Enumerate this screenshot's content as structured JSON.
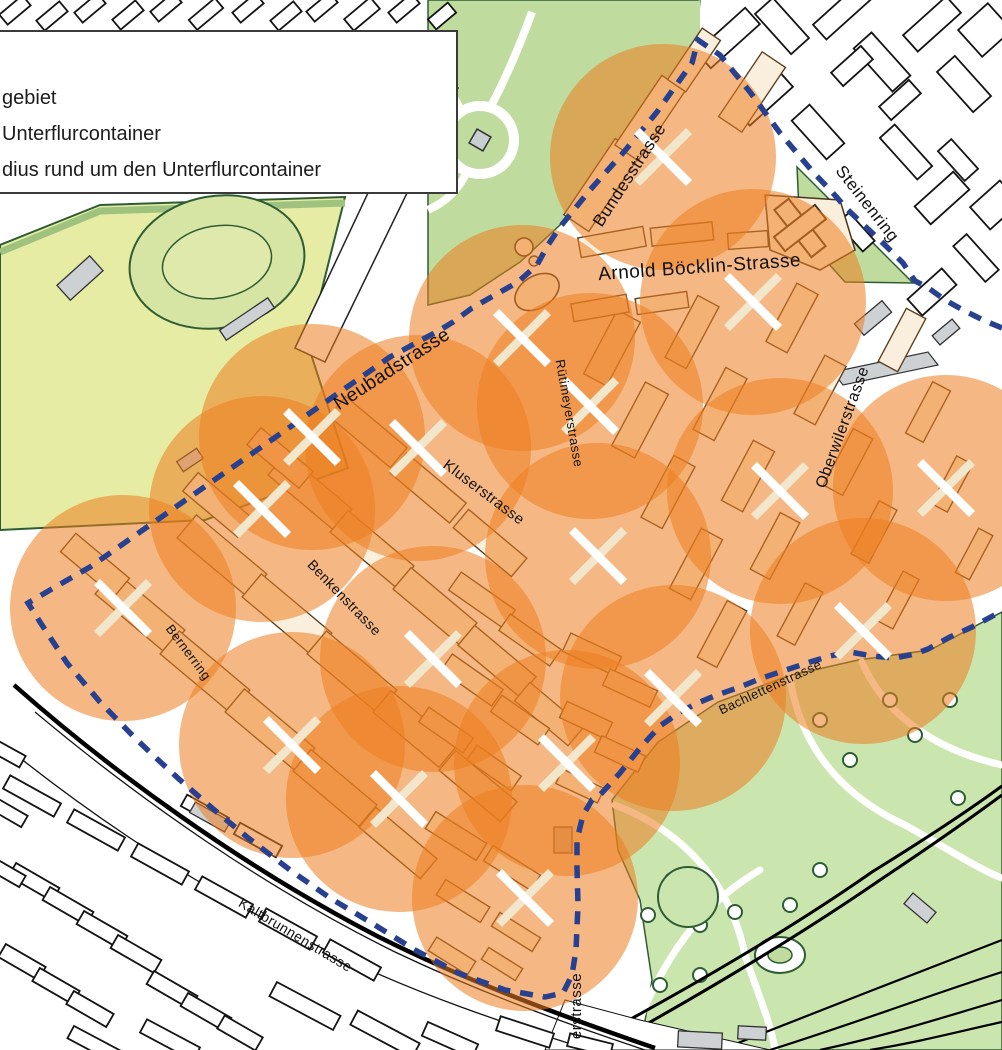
{
  "legend": {
    "items": [
      {
        "label": "gebiet"
      },
      {
        "label": "Unterflurcontainer"
      },
      {
        "label": "dius rund um den Unterflurcontainer"
      }
    ]
  },
  "map": {
    "colors": {
      "circle": "#ED7D1F",
      "circle_opacity": 0.55,
      "boundary": "#27408F",
      "marker_white": "#FFFFFF",
      "marker_cream": "#F2E7CC",
      "park_green": "#BFDB9E",
      "field_green": "#E6ECA4",
      "track_green": "#D6E4A4",
      "park_light": "#CBE5AF",
      "building_tint": "#FAEFDC",
      "building_outline_inner": "#5C4120",
      "building_outline_outer": "#141414",
      "gray_building": "#CDD1D3",
      "street_text": "#101010"
    },
    "containers": {
      "radius": 113,
      "points": [
        [
          663,
          157
        ],
        [
          753,
          302
        ],
        [
          522,
          338
        ],
        [
          590,
          406
        ],
        [
          312,
          437
        ],
        [
          418,
          448
        ],
        [
          780,
          491
        ],
        [
          946,
          488
        ],
        [
          262,
          509
        ],
        [
          123,
          608
        ],
        [
          598,
          556
        ],
        [
          863,
          631
        ],
        [
          433,
          659
        ],
        [
          673,
          698
        ],
        [
          292,
          745
        ],
        [
          567,
          763
        ],
        [
          399,
          799
        ],
        [
          525,
          898
        ]
      ]
    },
    "boundary": [
      [
        1002,
        328
      ],
      [
        983,
        320
      ],
      [
        963,
        310
      ],
      [
        945,
        300
      ],
      [
        927,
        287
      ],
      [
        915,
        281
      ],
      [
        903,
        263
      ],
      [
        887,
        247
      ],
      [
        867,
        228
      ],
      [
        848,
        210
      ],
      [
        832,
        192
      ],
      [
        813,
        172
      ],
      [
        780,
        133
      ],
      [
        750,
        92
      ],
      [
        720,
        55
      ],
      [
        698,
        40
      ],
      [
        692,
        63
      ],
      [
        657,
        112
      ],
      [
        623,
        153
      ],
      [
        590,
        190
      ],
      [
        560,
        227
      ],
      [
        548,
        245
      ],
      [
        537,
        265
      ],
      [
        518,
        282
      ],
      [
        495,
        295
      ],
      [
        472,
        308
      ],
      [
        453,
        322
      ],
      [
        440,
        330
      ],
      [
        390,
        357
      ],
      [
        340,
        392
      ],
      [
        290,
        427
      ],
      [
        240,
        462
      ],
      [
        190,
        497
      ],
      [
        140,
        532
      ],
      [
        90,
        567
      ],
      [
        45,
        593
      ],
      [
        28,
        603
      ],
      [
        40,
        622
      ],
      [
        67,
        663
      ],
      [
        100,
        702
      ],
      [
        135,
        738
      ],
      [
        155,
        757
      ],
      [
        180,
        780
      ],
      [
        212,
        808
      ],
      [
        247,
        837
      ],
      [
        290,
        870
      ],
      [
        330,
        898
      ],
      [
        370,
        922
      ],
      [
        415,
        950
      ],
      [
        458,
        973
      ],
      [
        505,
        990
      ],
      [
        545,
        997
      ],
      [
        563,
        993
      ],
      [
        572,
        975
      ],
      [
        576,
        950
      ],
      [
        578,
        905
      ],
      [
        577,
        868
      ],
      [
        577,
        840
      ],
      [
        583,
        815
      ],
      [
        592,
        800
      ],
      [
        600,
        795
      ],
      [
        620,
        773
      ],
      [
        640,
        748
      ],
      [
        660,
        726
      ],
      [
        680,
        712
      ],
      [
        700,
        702
      ],
      [
        717,
        695
      ],
      [
        740,
        687
      ],
      [
        762,
        678
      ],
      [
        783,
        671
      ],
      [
        810,
        662
      ],
      [
        830,
        656
      ],
      [
        850,
        652
      ],
      [
        872,
        656
      ],
      [
        895,
        658
      ],
      [
        915,
        654
      ],
      [
        928,
        649
      ],
      [
        950,
        637
      ],
      [
        972,
        627
      ],
      [
        1002,
        611
      ]
    ],
    "streets": [
      {
        "name": "Bundesstrasse",
        "x": 634,
        "y": 178,
        "rot": -57,
        "size": 17
      },
      {
        "name": "Steinenring",
        "x": 863,
        "y": 207,
        "rot": 52,
        "size": 17
      },
      {
        "name": "Arnold Böcklin-Strasse",
        "x": 700,
        "y": 273,
        "rot": -4,
        "size": 19
      },
      {
        "name": "Neubadstrasse",
        "x": 395,
        "y": 374,
        "rot": -33,
        "size": 19
      },
      {
        "name": "Rütimeyerstrasse",
        "x": 565,
        "y": 414,
        "rot": 80,
        "size": 13
      },
      {
        "name": "Kluserstrasse",
        "x": 481,
        "y": 496,
        "rot": 37,
        "size": 15
      },
      {
        "name": "Benkenstrasse",
        "x": 341,
        "y": 601,
        "rot": 46,
        "size": 14
      },
      {
        "name": "Bernerring",
        "x": 185,
        "y": 655,
        "rot": 53,
        "size": 13
      },
      {
        "name": "Oberwilerstrasse",
        "x": 847,
        "y": 429,
        "rot": -70,
        "size": 16
      },
      {
        "name": "Bachlettenstrasse",
        "x": 772,
        "y": 691,
        "rot": -25,
        "size": 13
      },
      {
        "name": "Kaltbrunnenstrasse",
        "x": 293,
        "y": 939,
        "rot": 31,
        "size": 14
      },
      {
        "name": "erstrasse",
        "x": 581,
        "y": 1006,
        "rot": -90,
        "size": 15
      }
    ]
  }
}
